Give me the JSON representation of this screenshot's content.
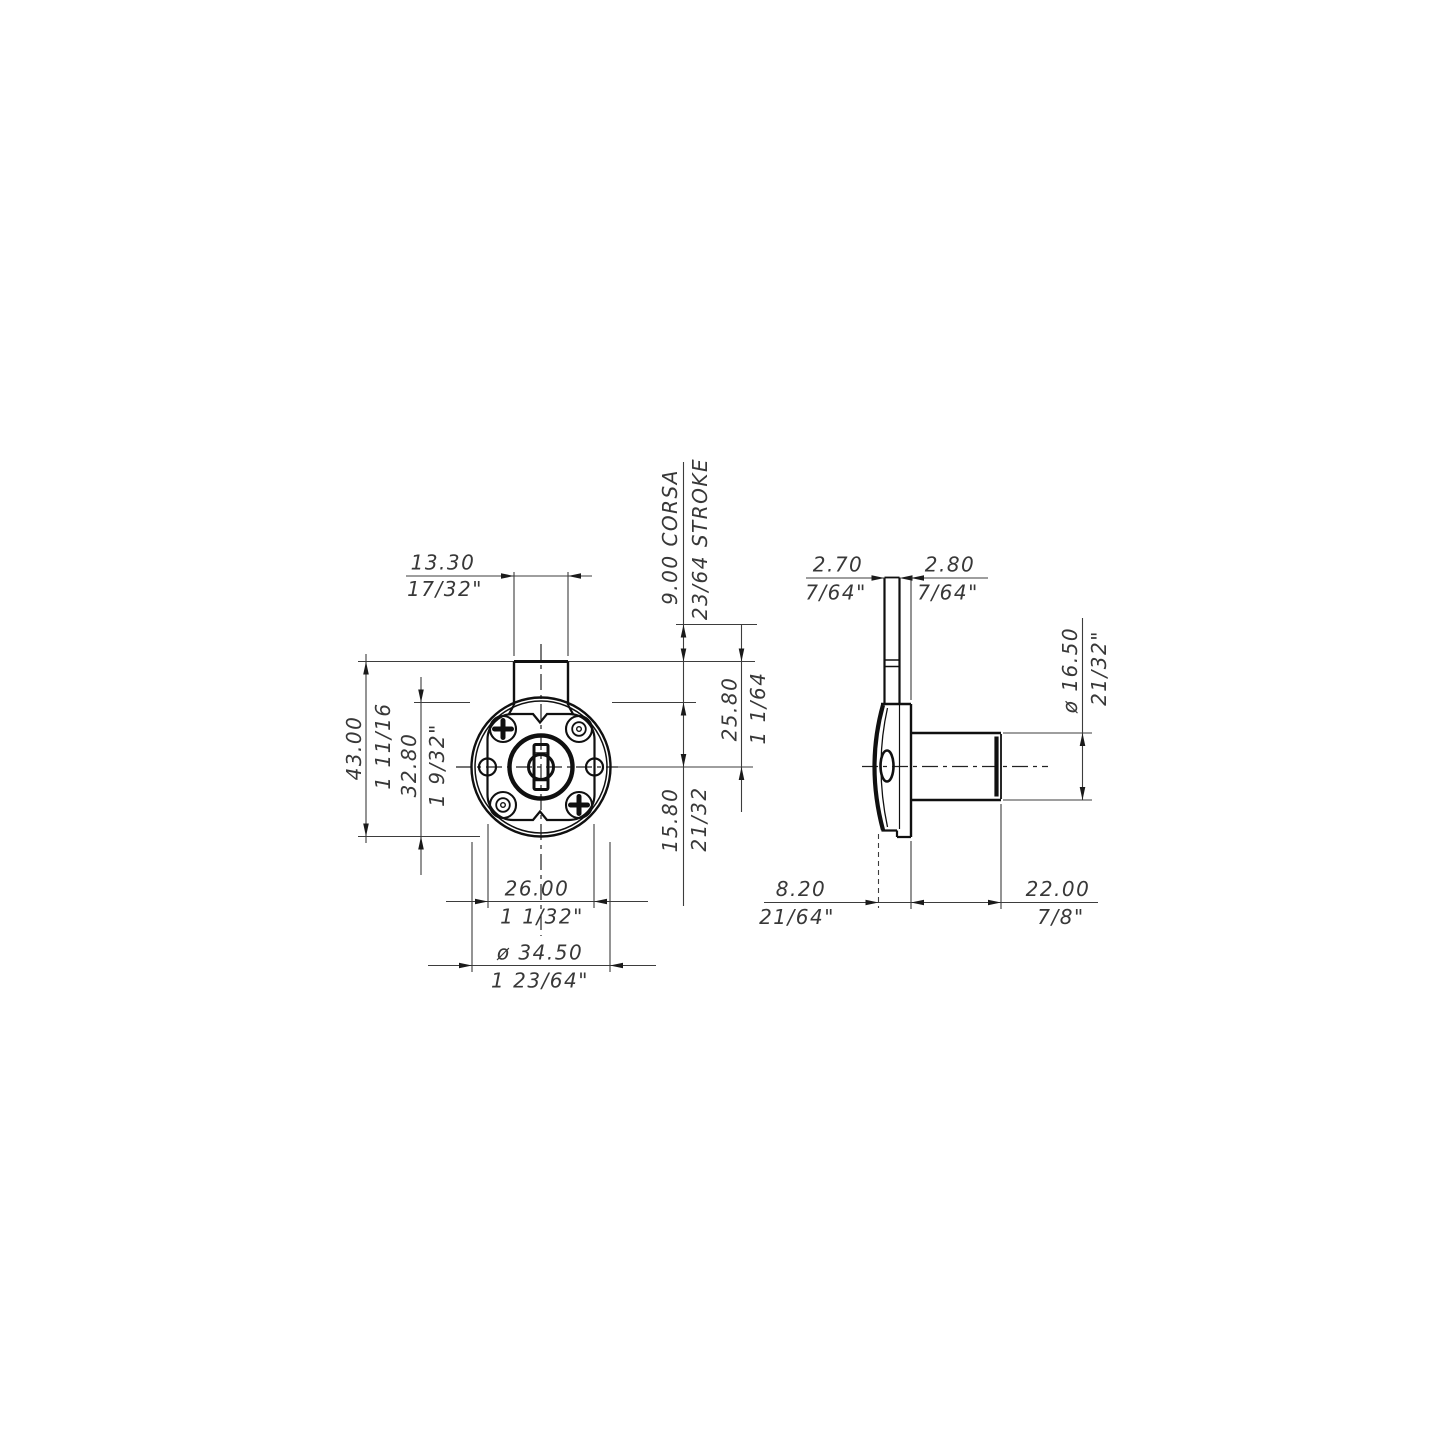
{
  "page": {
    "background": "#ffffff",
    "line_color": "#101010",
    "dim_color": "#383838"
  },
  "dims": {
    "front": {
      "neck_width": {
        "mm": "13.30",
        "in": "17/32\""
      },
      "stroke": {
        "mm": "9.00 CORSA",
        "in": "23/64 STROKE"
      },
      "total_height": {
        "mm": "43.00",
        "in": "1 11/16"
      },
      "body_height": {
        "mm": "32.80",
        "in": "1 9/32\""
      },
      "center_to_top": {
        "mm": "25.80",
        "in": "1 1/64"
      },
      "center_to_face": {
        "mm": "15.80",
        "in": "21/32"
      },
      "hole_spacing": {
        "mm": "26.00",
        "in": "1 1/32\""
      },
      "outer_diameter": {
        "mm": "ø 34.50",
        "in": "1 23/64\""
      }
    },
    "side": {
      "latch_thickness": {
        "mm": "2.70",
        "in": "7/64\""
      },
      "latch_offset": {
        "mm": "2.80",
        "in": "7/64\""
      },
      "barrel_diameter": {
        "mm": "ø 16.50",
        "in": "21/32\""
      },
      "body_depth": {
        "mm": "8.20",
        "in": "21/64\""
      },
      "barrel_length": {
        "mm": "22.00",
        "in": "7/8\""
      }
    }
  }
}
